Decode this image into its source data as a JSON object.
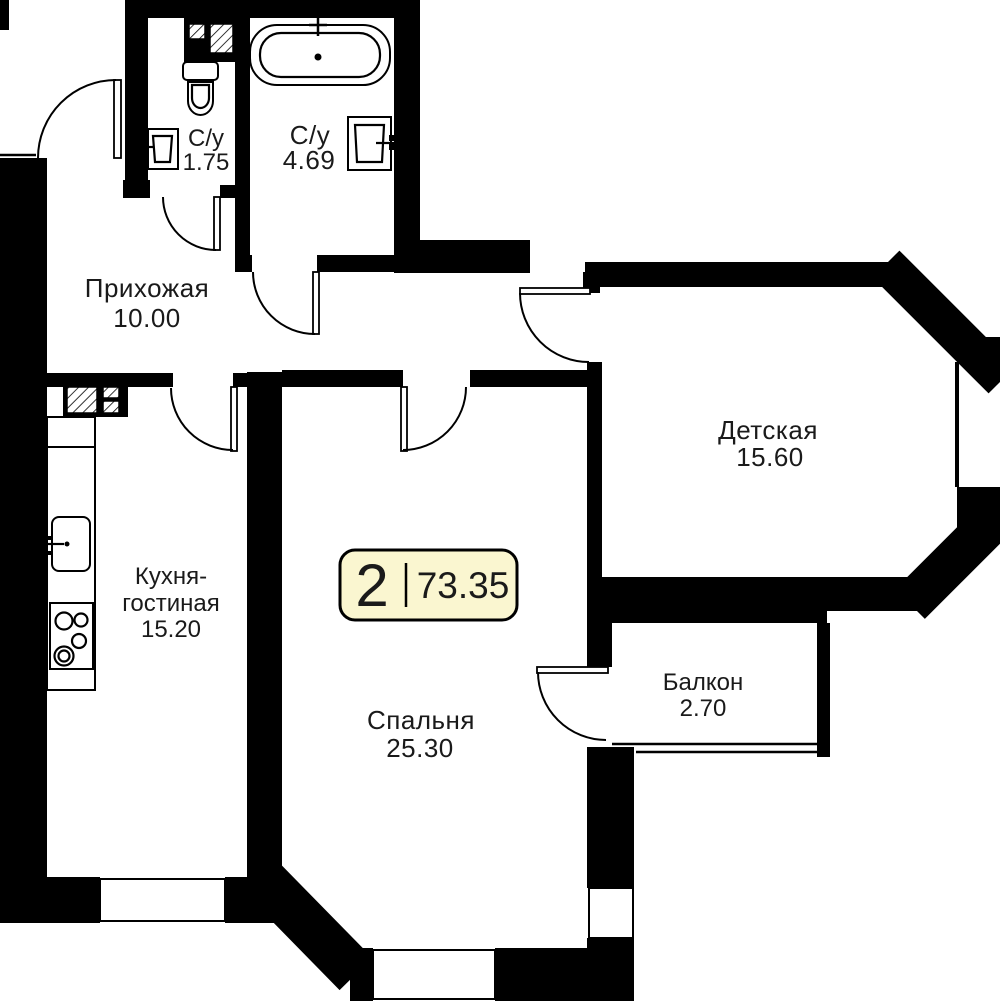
{
  "badge": {
    "rooms_count": "2",
    "total_area": "73.35"
  },
  "rooms": {
    "bathroom_small": {
      "name": "С/у",
      "area": "1.75"
    },
    "bathroom_large": {
      "name": "С/у",
      "area": "4.69"
    },
    "hallway": {
      "name": "Прихожая",
      "area": "10.00"
    },
    "kitchen_living": {
      "name_line1": "Кухня-",
      "name_line2": "гостиная",
      "area": "15.20"
    },
    "bedroom": {
      "name": "Спальня",
      "area": "25.30"
    },
    "kids_room": {
      "name": "Детская",
      "area": "15.60"
    },
    "balcony": {
      "name": "Балкон",
      "area": "2.70"
    }
  },
  "fixtures": [
    "bathtub",
    "toilet",
    "bathroom-sink",
    "kitchen-sink",
    "stove",
    "ventilation-shaft",
    "kitchen-counter"
  ],
  "colors": {
    "wall": "#000000",
    "background": "#ffffff",
    "badge_fill": "#faf6d0",
    "badge_border": "#000000",
    "text": "#1a1a1a"
  }
}
